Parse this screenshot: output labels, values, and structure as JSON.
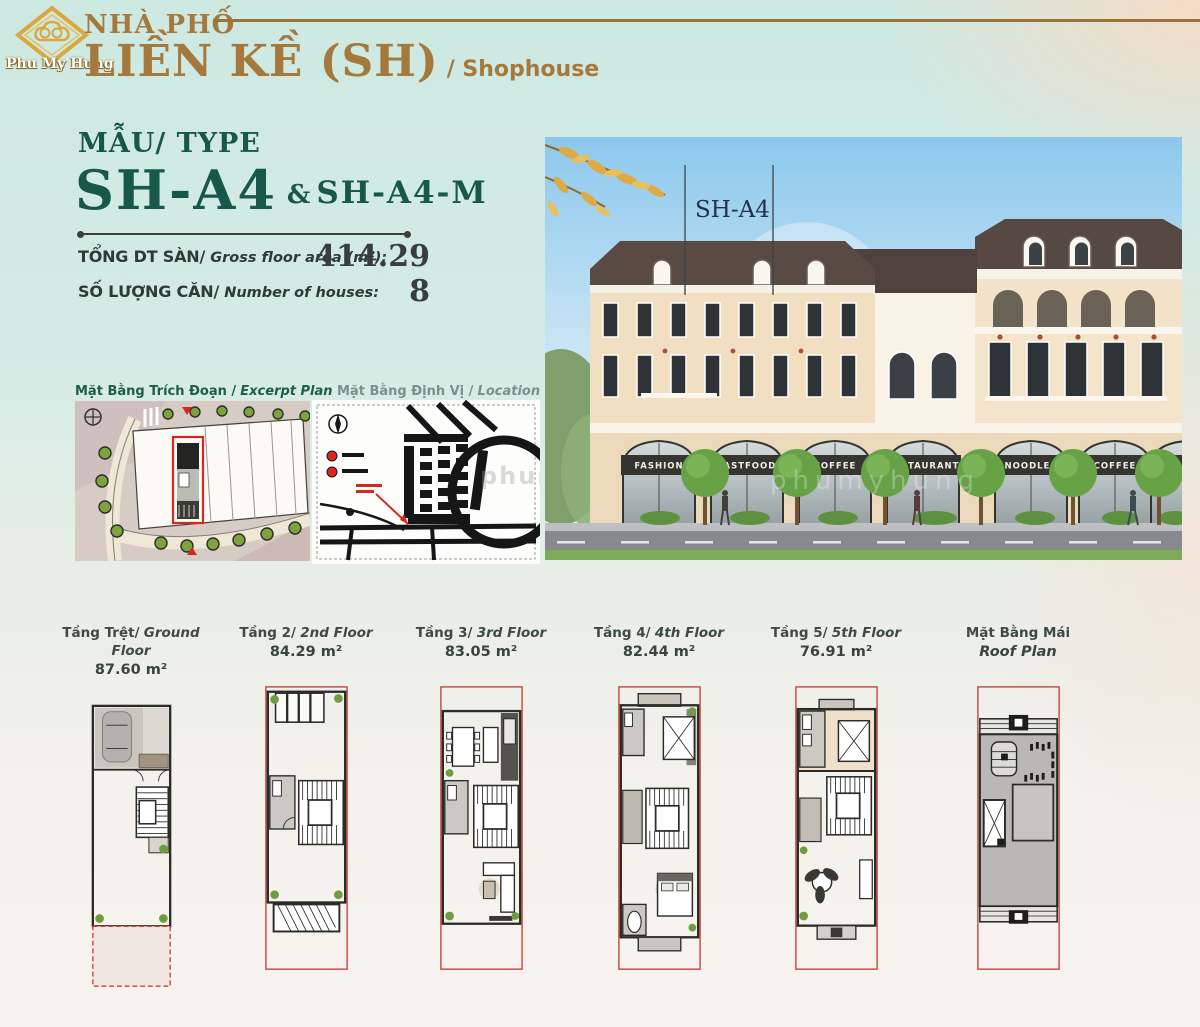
{
  "colors": {
    "accent_green": "#17584A",
    "accent_bronze": "#A5793C",
    "highlight_red": "#C6403A",
    "ink": "#363C40"
  },
  "brand": {
    "logo_text": "Phu My Hung"
  },
  "header": {
    "category": "NHÀ PHỐ",
    "title": "LIỀN KỀ (SH)",
    "subtitle": "/ Shophouse"
  },
  "type_block": {
    "label": "MẪU/ TYPE",
    "code": "SH-A4",
    "conjunction": "&",
    "code_alt": "SH-A4-M"
  },
  "stats": [
    {
      "label_vn": "TỔNG DT SÀN/",
      "label_en": "Gross floor area (m²):",
      "value": "414.29"
    },
    {
      "label_vn": "SỐ LƯỢNG CĂN/",
      "label_en": "Number of houses:",
      "value": "8"
    }
  ],
  "mini_plans": [
    {
      "title_vn": "Mặt Bằng Trích Đoạn /",
      "title_en": "Excerpt Plan"
    },
    {
      "title_vn": "Mặt Bằng Định Vị /",
      "title_en": "Location Plan"
    }
  ],
  "render": {
    "unit_label": "SH-A4",
    "watermark": "phumyhung",
    "signs": [
      "FASHION",
      "FASTFOOD",
      "COFFEE",
      "RESTAURANT",
      "NOODLES",
      "COFFEE",
      "MENSWEAR"
    ]
  },
  "floors": [
    {
      "label_vn": "Tầng Trệt/",
      "label_en": "Ground Floor",
      "area": "87.60 m²"
    },
    {
      "label_vn": "Tầng 2/",
      "label_en": "2nd Floor",
      "area": "84.29 m²"
    },
    {
      "label_vn": "Tầng 3/",
      "label_en": "3rd Floor",
      "area": "83.05 m²"
    },
    {
      "label_vn": "Tầng 4/",
      "label_en": "4th Floor",
      "area": "82.44 m²"
    },
    {
      "label_vn": "Tầng 5/",
      "label_en": "5th Floor",
      "area": "76.91 m²"
    },
    {
      "label_vn": "Mặt Bằng Mái",
      "label_en": "",
      "area": "Roof Plan"
    }
  ]
}
